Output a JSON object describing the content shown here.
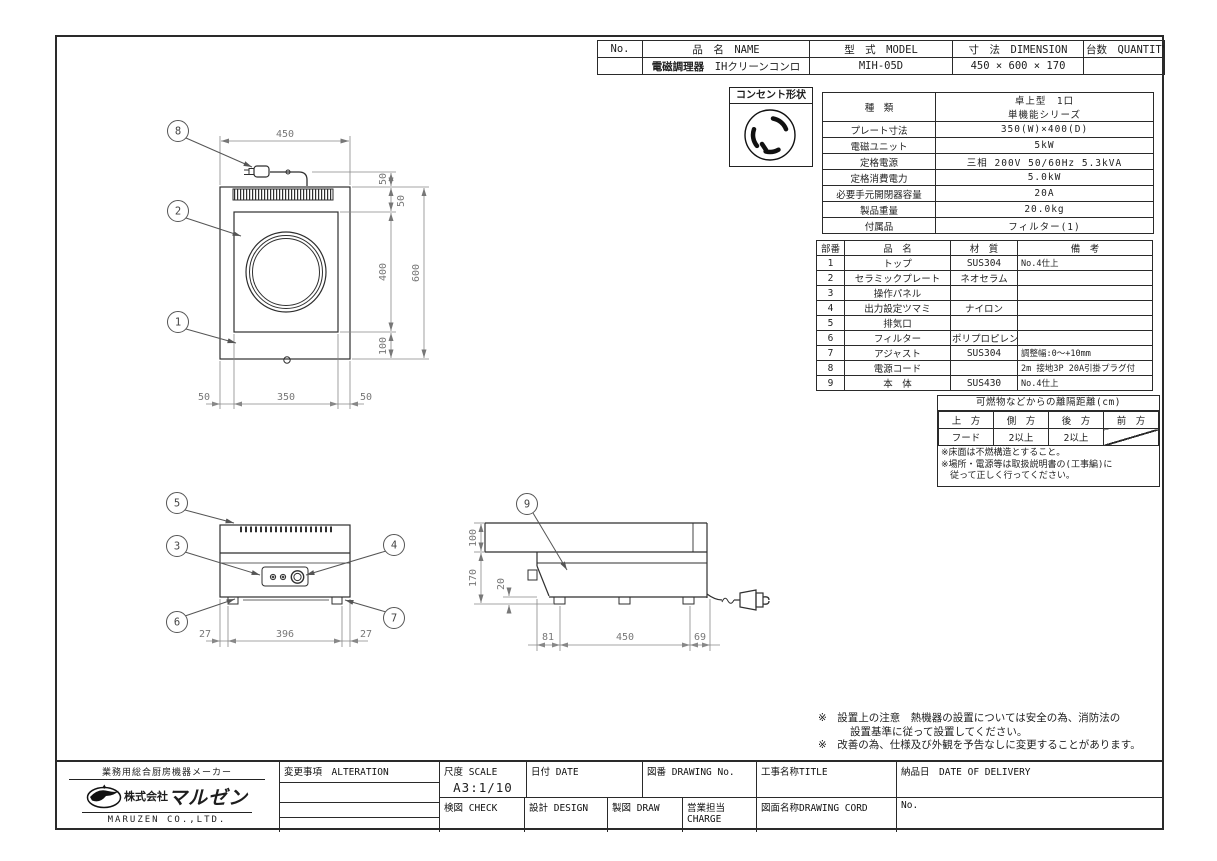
{
  "header_table": {
    "cols": [
      "No.",
      "品　名　NAME",
      "型　式　MODEL",
      "寸　法　DIMENSION",
      "台数　QUANTITY"
    ],
    "product_type": "電磁調理器",
    "product_name": "IHクリーンコンロ",
    "model": "MIH-05D",
    "dimension": "450 × 600 × 170"
  },
  "outlet": {
    "label": "コンセント形状"
  },
  "spec": {
    "rows": [
      {
        "label": "種　類",
        "value": "卓上型　1口",
        "value2": "単機能シリーズ"
      },
      {
        "label": "プレート寸法",
        "value": "350(W)×400(D)"
      },
      {
        "label": "電磁ユニット",
        "value": "5kW"
      },
      {
        "label": "定格電源",
        "value": "三相 200V 50/60Hz 5.3kVA"
      },
      {
        "label": "定格消費電力",
        "value": "5.0kW"
      },
      {
        "label": "必要手元開閉器容量",
        "value": "20A"
      },
      {
        "label": "製品重量",
        "value": "20.0kg"
      },
      {
        "label": "付属品",
        "value": "フィルター(1)"
      }
    ]
  },
  "parts": {
    "headers": [
      "部番",
      "品　名",
      "材　質",
      "備　考"
    ],
    "rows": [
      [
        "1",
        "トップ",
        "SUS304",
        "No.4仕上"
      ],
      [
        "2",
        "セラミックプレート",
        "ネオセラム",
        ""
      ],
      [
        "3",
        "操作パネル",
        "",
        ""
      ],
      [
        "4",
        "出力設定ツマミ",
        "ナイロン",
        ""
      ],
      [
        "5",
        "排気口",
        "",
        ""
      ],
      [
        "6",
        "フィルター",
        "ポリプロピレン",
        ""
      ],
      [
        "7",
        "アジャスト",
        "SUS304",
        "調整幅:0〜+10mm"
      ],
      [
        "8",
        "電源コード",
        "",
        "2m 接地3P 20A引掛プラグ付"
      ],
      [
        "9",
        "本　体",
        "SUS430",
        "No.4仕上"
      ]
    ]
  },
  "clearance": {
    "title": "可燃物などからの離隔距離(cm)",
    "headers": [
      "上　方",
      "側　方",
      "後　方",
      "前　方"
    ],
    "row": [
      "フード",
      "2以上",
      "2以上"
    ],
    "notes": [
      "※床面は不燃構造とすること。",
      "※場所・電源等は取扱説明書の(工事編)に",
      "　従って正しく行ってください。"
    ]
  },
  "notes": [
    "※　設置上の注意　熱機器の設置については安全の為、消防法の",
    "設置基準に従って設置してください。",
    "※　改善の為、仕様及び外観を予告なしに変更することがあります。"
  ],
  "title_block": {
    "tagline": "業務用総合厨房機器メーカー",
    "company_prefix": "株式会社",
    "company_brand": "マルゼン",
    "company_en": "MARUZEN CO.,LTD.",
    "alteration": "変更事項　ALTERATION",
    "scale_label": "尺度 SCALE",
    "scale_value": "A3:1/10",
    "date_label": "日付 DATE",
    "drawing_no_label": "図番 DRAWING No.",
    "title_label": "工事名称TITLE",
    "check_label": "検図 CHECK",
    "design_label": "設計 DESIGN",
    "draw_label": "製図 DRAW",
    "charge_label": "営業担当CHARGE",
    "drawing_cord_label": "図面名称DRAWING CORD",
    "delivery_label": "納品日　DATE OF DELIVERY",
    "no_label": "No."
  },
  "dims": {
    "plan_width": "450",
    "plan_cord": "50",
    "plan_seg_top": "50",
    "plan_seg_plate": "400",
    "plan_seg_bottom": "100",
    "plan_depth": "600",
    "plan_left": "50",
    "plan_center": "350",
    "plan_right": "50",
    "front_left": "27",
    "front_center": "396",
    "front_right": "27",
    "side_top": "100",
    "side_height": "170",
    "side_foot": "20",
    "side_back": "81",
    "side_center": "450",
    "side_front": "69"
  },
  "callouts": {
    "b1": "1",
    "b2": "2",
    "b3": "3",
    "b4": "4",
    "b5": "5",
    "b6": "6",
    "b7": "7",
    "b8": "8",
    "b9": "9"
  }
}
